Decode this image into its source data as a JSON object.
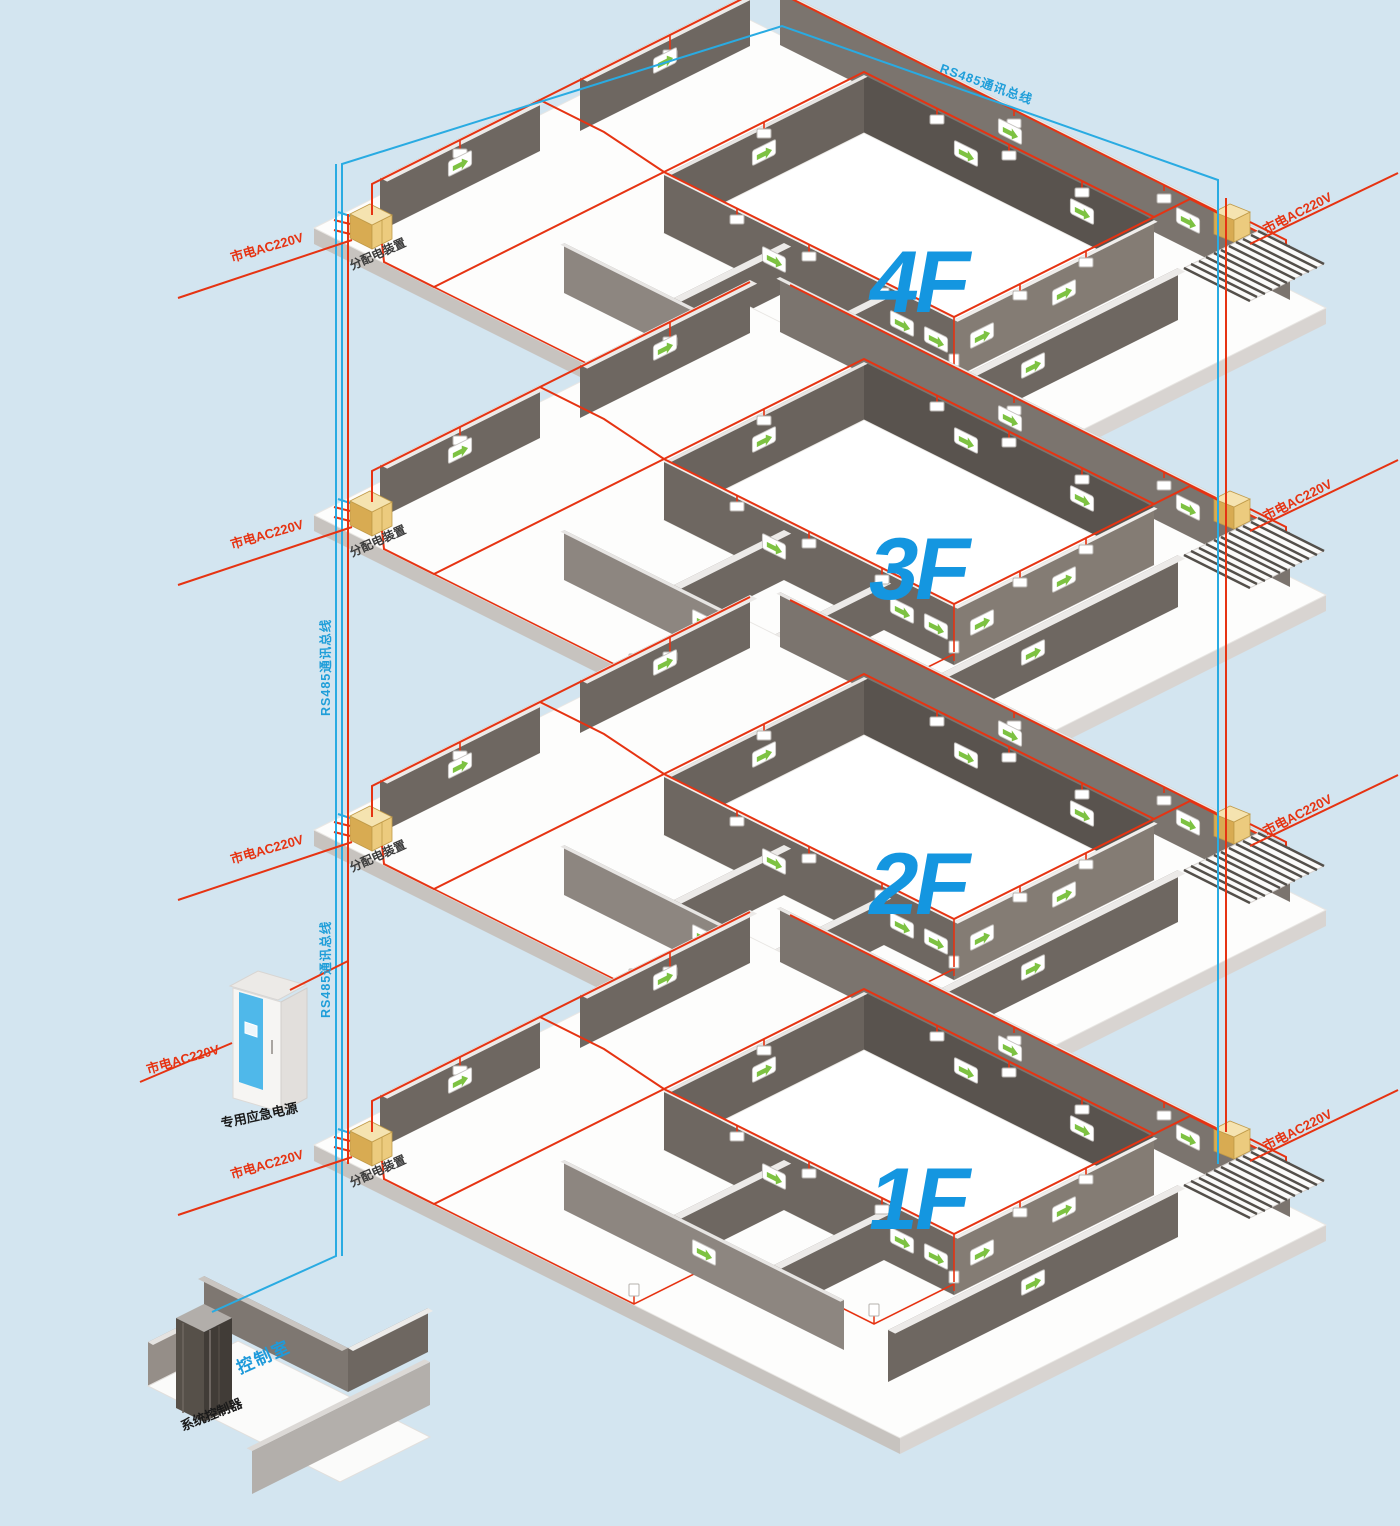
{
  "background": "#d3e5f0",
  "colors": {
    "power_line_red": "#e63312",
    "bus_line_blue": "#29abe2",
    "bus_label_blue": "#1f9ed9",
    "floor_label_blue": "#1496e0",
    "distribution_box_yellow": "#eccb7e",
    "exit_arrow_green": "#7dc242",
    "wall_gray": "#6e6761"
  },
  "bus": {
    "top_label": "RS485通讯总线",
    "riser_label_upper": "RS485通讯总线",
    "riser_label_lower": "RS485通讯总线"
  },
  "floors": [
    {
      "id": "4F",
      "label": "4F",
      "left_power_label": "市电AC220V",
      "right_power_label": "市电AC220V",
      "distribution_box_label": "分配电装置"
    },
    {
      "id": "3F",
      "label": "3F",
      "left_power_label": "市电AC220V",
      "right_power_label": "市电AC220V",
      "distribution_box_label": "分配电装置"
    },
    {
      "id": "2F",
      "label": "2F",
      "left_power_label": "市电AC220V",
      "right_power_label": "市电AC220V",
      "distribution_box_label": "分配电装置"
    },
    {
      "id": "1F",
      "label": "1F",
      "left_power_label": "市电AC220V",
      "right_power_label": "市电AC220V",
      "distribution_box_label": "分配电装置"
    }
  ],
  "emergency_power_supply": {
    "name_label": "专用应急电源",
    "power_label": "市电AC220V"
  },
  "control_room": {
    "room_label": "控制室",
    "controller_label": "系统控制器"
  }
}
